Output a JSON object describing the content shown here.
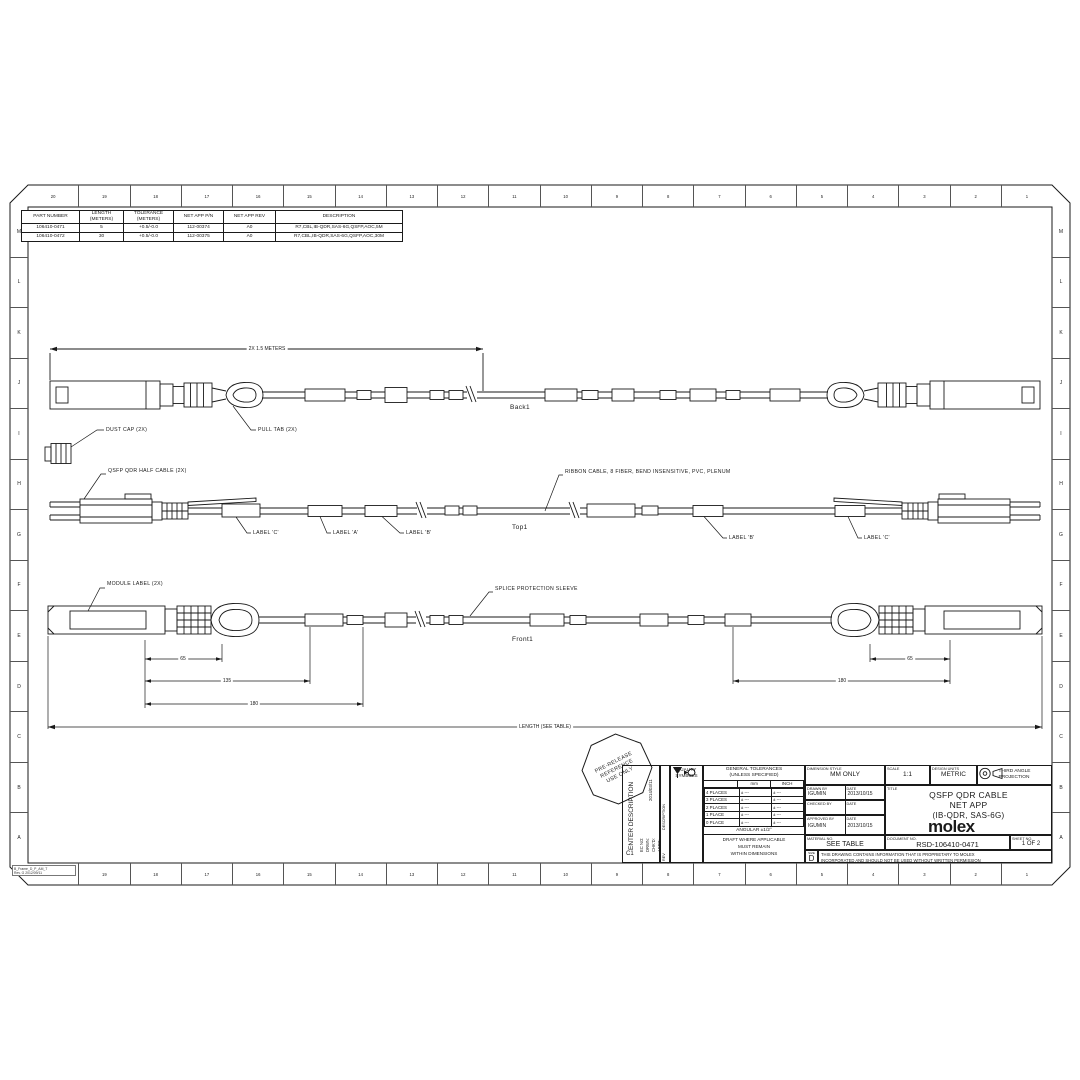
{
  "border": {
    "top_numbers": [
      "20",
      "19",
      "18",
      "17",
      "16",
      "15",
      "14",
      "13",
      "12",
      "11",
      "10",
      "9",
      "8",
      "7",
      "6",
      "5",
      "4",
      "3",
      "2",
      "1"
    ],
    "bottom_numbers": [
      "",
      "19",
      "18",
      "17",
      "16",
      "15",
      "14",
      "13",
      "12",
      "11",
      "10",
      "9",
      "8",
      "7",
      "6",
      "5",
      "4",
      "3",
      "2",
      "1"
    ],
    "left_letters": [
      "M",
      "L",
      "K",
      "J",
      "I",
      "H",
      "G",
      "F",
      "E",
      "D",
      "C",
      "B",
      "A"
    ],
    "right_letters": [
      "M",
      "L",
      "K",
      "J",
      "I",
      "H",
      "G",
      "F",
      "E",
      "D",
      "C",
      "B",
      "A"
    ]
  },
  "footer_note": {
    "line1": "B_Frame_D_P_AM_T",
    "line2": "Rev. G 2012/09/11"
  },
  "parts_table": {
    "headers": [
      {
        "l1": "PART NUMBER",
        "l2": ""
      },
      {
        "l1": "LENGTH",
        "l2": "(METERS)"
      },
      {
        "l1": "TOLERANCE",
        "l2": "(METERS)"
      },
      {
        "l1": "NET APP P/N",
        "l2": ""
      },
      {
        "l1": "NET APP REV",
        "l2": ""
      },
      {
        "l1": "DESCRIPTION",
        "l2": ""
      }
    ],
    "rows": [
      {
        "pn": "106410-0471",
        "len": "5",
        "tol": "+0.5/-0.0",
        "app": "112-00374",
        "rev": "A0",
        "desc": "R7,CBL,IB-QDR,SAS-6G,QSFP,AOC,5M"
      },
      {
        "pn": "106410-0472",
        "len": "30",
        "tol": "+0.5/-0.0",
        "app": "112-00375",
        "rev": "A0",
        "desc": "R7,CBL,IB-QDR,SAS-6G,QSFP,AOC,30M"
      }
    ]
  },
  "views": {
    "back": {
      "name": "Back1",
      "dim_label": "2X 1.5 METERS",
      "dust_cap": "DUST CAP (2X)",
      "pull_tab": "PULL TAB (2X)"
    },
    "top": {
      "name": "Top1",
      "half_cable": "QSFP QDR HALF CABLE (2X)",
      "ribbon": "RIBBON CABLE, 8 FIBER, BEND INSENSITIVE, PVC, PLENUM",
      "sleeve_labels": [
        "LABEL 'C'",
        "LABEL 'A'",
        "LABEL 'B'",
        "LABEL 'B'",
        "LABEL 'C'"
      ]
    },
    "front": {
      "name": "Front1",
      "module_label": "MODULE LABEL (2X)",
      "splice": "SPLICE PROTECTION SLEEVE",
      "dims": [
        "65",
        "135",
        "180",
        "65",
        "180"
      ],
      "length_label": "LENGTH (SEE TABLE)"
    }
  },
  "stamp": {
    "line1": "PRE-RELEASE",
    "line2": "REFERENCE",
    "line3": "USE ONLY"
  },
  "title_block": {
    "revision": {
      "enter_description": "ENTER DESCRIPTION",
      "date": "2014/03/11",
      "f1": "EC NO:",
      "f2": "DRWN:",
      "f3": "CHK'D:",
      "f4": "APPR:",
      "rev_value": "C1",
      "description_label": "DESCRIPTION",
      "rev_label": "REV"
    },
    "quality": {
      "title1": "QUALITY",
      "title2": "SYMBOLS"
    },
    "tolerances": {
      "title1": "GENERAL TOLERANCES",
      "title2": "(UNLESS SPECIFIED)",
      "col_mm": "mm",
      "col_inch": "INCH",
      "rows": [
        {
          "label": "4 PLACES",
          "mm": "± ---",
          "inch": "± ---"
        },
        {
          "label": "3 PLACES",
          "mm": "± ---",
          "inch": "± ---"
        },
        {
          "label": "2 PLACES",
          "mm": "± ---",
          "inch": "± ---"
        },
        {
          "label": "1 PLACE",
          "mm": "± ---",
          "inch": "± ---"
        },
        {
          "label": "0 PLACE",
          "mm": "± ---",
          "inch": "± ---"
        }
      ],
      "angular": "ANGULAR ±1/2°",
      "draft1": "DRAFT WHERE APPLICABLE",
      "draft2": "MUST REMAIN",
      "draft3": "WITHIN DIMENSIONS"
    },
    "dimension_style": {
      "label": "DIMENSION STYLE",
      "value": "MM ONLY"
    },
    "scale": {
      "label": "SCALE",
      "value": "1:1"
    },
    "design_units": {
      "label": "DESIGN UNITS",
      "value": "METRIC"
    },
    "projection": {
      "line1": "THIRD ANGLE",
      "line2": "PROJECTION"
    },
    "drawn": {
      "label": "DRAWN BY",
      "value": "IGUMIN",
      "date_label": "DATE",
      "date": "2013/10/15"
    },
    "checked": {
      "label": "CHECKED BY",
      "value": "",
      "date_label": "DATE",
      "date": ""
    },
    "approved": {
      "label": "APPROVED BY",
      "value": "IGUMIN",
      "date_label": "DATE",
      "date": "2013/10/15"
    },
    "title": {
      "label": "TITLE",
      "line1": "QSFP QDR CABLE",
      "line2": "NET APP",
      "line3": "(IB-QDR, SAS-6G)"
    },
    "logo": "molex",
    "material": {
      "label": "MATERIAL NO.",
      "value": "SEE TABLE"
    },
    "document": {
      "label": "DOCUMENT NO.",
      "value": "RSD-106410-0471"
    },
    "sheet": {
      "label": "SHEET NO.",
      "value": "1 OF 2"
    },
    "size": {
      "label": "SIZE",
      "value": "D"
    },
    "proprietary1": "THIS DRAWING CONTAINS INFORMATION THAT IS PROPRIETARY TO MOLEX",
    "proprietary2": "INCORPORATED AND SHOULD NOT BE USED WITHOUT WRITTEN PERMISSION"
  }
}
